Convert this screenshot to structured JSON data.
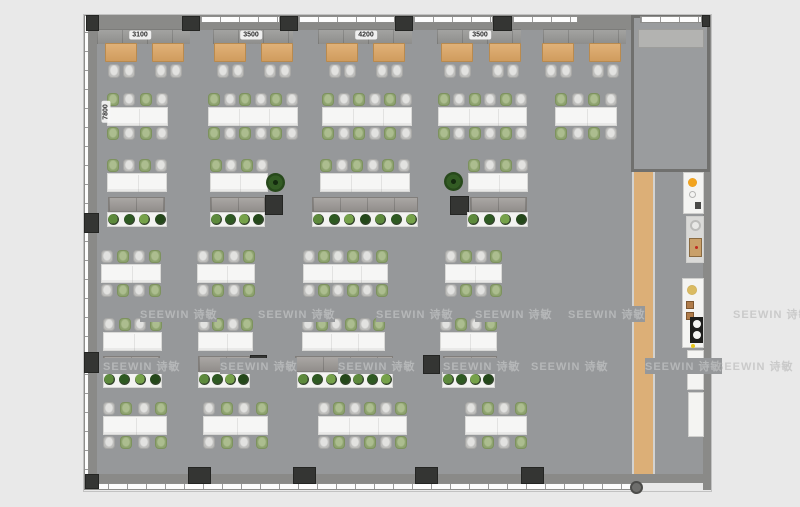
{
  "scene": {
    "width": 800,
    "height": 507,
    "background": "#e9e9e9",
    "floor_color": "#96989a",
    "accent_wood": "#dcaf77",
    "chair_green": "#8ea36f",
    "chair_gray": "#bebebc"
  },
  "dimension_labels": [
    {
      "text": "3100",
      "cx": 140,
      "cy": 35,
      "rot": 0
    },
    {
      "text": "3500",
      "cx": 251,
      "cy": 35,
      "rot": 0
    },
    {
      "text": "4200",
      "cx": 366,
      "cy": 35,
      "rot": 0
    },
    {
      "text": "3500",
      "cx": 480,
      "cy": 35,
      "rot": 0
    },
    {
      "text": "7800",
      "cx": 106,
      "cy": 112,
      "rot": -90
    }
  ],
  "watermark": {
    "text": "SEEWIN 诗敏",
    "instances": [
      {
        "x": 140,
        "y": 306,
        "v": "floor"
      },
      {
        "x": 258,
        "y": 306,
        "v": "floor"
      },
      {
        "x": 376,
        "y": 306,
        "v": "floor"
      },
      {
        "x": 475,
        "y": 306,
        "v": "floor"
      },
      {
        "x": 568,
        "y": 306,
        "v": "floor"
      },
      {
        "x": 733,
        "y": 306,
        "v": "margin"
      },
      {
        "x": 103,
        "y": 358,
        "v": "floor"
      },
      {
        "x": 220,
        "y": 358,
        "v": "floor"
      },
      {
        "x": 338,
        "y": 358,
        "v": "floor"
      },
      {
        "x": 443,
        "y": 358,
        "v": "floor"
      },
      {
        "x": 531,
        "y": 358,
        "v": "floor"
      },
      {
        "x": 645,
        "y": 358,
        "v": "floor"
      },
      {
        "x": 716,
        "y": 358,
        "v": "margin"
      }
    ]
  },
  "shell": {
    "floor": {
      "x": 89,
      "y": 16,
      "w": 614,
      "h": 458
    },
    "outline": {
      "x": 83,
      "y": 14,
      "w": 629,
      "h": 478
    },
    "top_band": {
      "x": 84,
      "y": 15,
      "w": 627,
      "h": 15
    },
    "bottom_band": {
      "x": 84,
      "y": 474,
      "w": 627,
      "h": 9
    },
    "left_band": {
      "x": 89,
      "y": 15,
      "w": 8,
      "h": 459
    },
    "right_band": {
      "x": 703,
      "y": 15,
      "w": 8,
      "h": 475
    },
    "windows_top": [
      {
        "x": 200,
        "y": 16,
        "w": 80,
        "h": 7
      },
      {
        "x": 298,
        "y": 16,
        "w": 97,
        "h": 7
      },
      {
        "x": 413,
        "y": 16,
        "w": 80,
        "h": 7
      },
      {
        "x": 512,
        "y": 16,
        "w": 66,
        "h": 7
      },
      {
        "x": 640,
        "y": 16,
        "w": 62,
        "h": 7
      }
    ],
    "window_bottom": {
      "x": 88,
      "y": 483,
      "w": 545,
      "h": 7
    },
    "window_left": {
      "x": 84,
      "y": 15,
      "w": 5,
      "h": 475
    },
    "wood_strip": {
      "x": 632,
      "y": 172,
      "w": 23,
      "h": 302
    },
    "room": {
      "x": 631,
      "y": 15,
      "w": 79,
      "h": 157,
      "strip": {
        "x": 638,
        "y": 29,
        "w": 66,
        "h": 19
      }
    },
    "round_column": {
      "x": 630,
      "y": 481,
      "d": 13
    }
  },
  "columns": [
    {
      "x": 86,
      "y": 15,
      "w": 13,
      "h": 16
    },
    {
      "x": 182,
      "y": 16,
      "w": 18,
      "h": 15
    },
    {
      "x": 280,
      "y": 16,
      "w": 18,
      "h": 15
    },
    {
      "x": 395,
      "y": 16,
      "w": 18,
      "h": 15
    },
    {
      "x": 493,
      "y": 16,
      "w": 19,
      "h": 15
    },
    {
      "x": 702,
      "y": 15,
      "w": 8,
      "h": 12
    },
    {
      "x": 84,
      "y": 213,
      "w": 15,
      "h": 20
    },
    {
      "x": 84,
      "y": 352,
      "w": 15,
      "h": 21
    },
    {
      "x": 265,
      "y": 195,
      "w": 18,
      "h": 20
    },
    {
      "x": 450,
      "y": 196,
      "w": 19,
      "h": 19
    },
    {
      "x": 250,
      "y": 355,
      "w": 17,
      "h": 19
    },
    {
      "x": 423,
      "y": 355,
      "w": 17,
      "h": 19
    },
    {
      "x": 85,
      "y": 474,
      "w": 14,
      "h": 15
    },
    {
      "x": 188,
      "y": 467,
      "w": 23,
      "h": 17
    },
    {
      "x": 293,
      "y": 467,
      "w": 23,
      "h": 17
    },
    {
      "x": 415,
      "y": 467,
      "w": 23,
      "h": 17
    },
    {
      "x": 521,
      "y": 467,
      "w": 23,
      "h": 17
    }
  ],
  "top_cabinets": [
    {
      "x": 97,
      "y": 29,
      "w": 93,
      "h": 15
    },
    {
      "x": 213,
      "y": 29,
      "w": 80,
      "h": 15
    },
    {
      "x": 318,
      "y": 29,
      "w": 94,
      "h": 15
    },
    {
      "x": 437,
      "y": 29,
      "w": 84,
      "h": 15
    },
    {
      "x": 543,
      "y": 29,
      "w": 83,
      "h": 15
    }
  ],
  "bench_tables": {
    "y": 43,
    "w": 32,
    "h": 19,
    "chair_y": 64,
    "xs": [
      105,
      152,
      214,
      261,
      326,
      373,
      441,
      489,
      542,
      589
    ]
  },
  "desk_clusters": [
    {
      "x": 107,
      "y": 107,
      "w": 61,
      "seats": 4,
      "sides": 2,
      "firstGreen": true
    },
    {
      "x": 208,
      "y": 107,
      "w": 90,
      "seats": 6,
      "sides": 2,
      "firstGreen": true
    },
    {
      "x": 322,
      "y": 107,
      "w": 90,
      "seats": 6,
      "sides": 2,
      "firstGreen": true
    },
    {
      "x": 438,
      "y": 107,
      "w": 89,
      "seats": 6,
      "sides": 2,
      "firstGreen": true
    },
    {
      "x": 555,
      "y": 107,
      "w": 62,
      "seats": 4,
      "sides": 2,
      "firstGreen": true
    },
    {
      "x": 107,
      "y": 173,
      "w": 60,
      "seats": 4,
      "sides": 1,
      "firstGreen": true
    },
    {
      "x": 210,
      "y": 173,
      "w": 58,
      "seats": 4,
      "sides": 1,
      "firstGreen": true
    },
    {
      "x": 320,
      "y": 173,
      "w": 90,
      "seats": 6,
      "sides": 1,
      "firstGreen": true
    },
    {
      "x": 468,
      "y": 173,
      "w": 60,
      "seats": 4,
      "sides": 1,
      "firstGreen": true
    },
    {
      "x": 101,
      "y": 264,
      "w": 60,
      "seats": 4,
      "sides": 2,
      "firstGreen": false
    },
    {
      "x": 197,
      "y": 264,
      "w": 58,
      "seats": 4,
      "sides": 2,
      "firstGreen": false
    },
    {
      "x": 303,
      "y": 264,
      "w": 85,
      "seats": 6,
      "sides": 2,
      "firstGreen": false
    },
    {
      "x": 445,
      "y": 264,
      "w": 57,
      "seats": 4,
      "sides": 2,
      "firstGreen": false
    },
    {
      "x": 103,
      "y": 332,
      "w": 59,
      "seats": 4,
      "sides": 1,
      "firstGreen": false
    },
    {
      "x": 198,
      "y": 332,
      "w": 55,
      "seats": 4,
      "sides": 1,
      "firstGreen": false
    },
    {
      "x": 302,
      "y": 332,
      "w": 83,
      "seats": 6,
      "sides": 1,
      "firstGreen": false
    },
    {
      "x": 440,
      "y": 332,
      "w": 57,
      "seats": 4,
      "sides": 1,
      "firstGreen": false
    },
    {
      "x": 103,
      "y": 416,
      "w": 64,
      "seats": 4,
      "sides": 2,
      "firstGreen": false
    },
    {
      "x": 203,
      "y": 416,
      "w": 65,
      "seats": 4,
      "sides": 2,
      "firstGreen": false
    },
    {
      "x": 318,
      "y": 416,
      "w": 89,
      "seats": 6,
      "sides": 2,
      "firstGreen": false
    },
    {
      "x": 465,
      "y": 416,
      "w": 62,
      "seats": 4,
      "sides": 2,
      "firstGreen": false
    }
  ],
  "cabinets": [
    {
      "x": 108,
      "y": 197,
      "w": 57,
      "h": 15
    },
    {
      "x": 210,
      "y": 197,
      "w": 55,
      "h": 15
    },
    {
      "x": 312,
      "y": 197,
      "w": 106,
      "h": 15
    },
    {
      "x": 470,
      "y": 197,
      "w": 57,
      "h": 15
    },
    {
      "x": 103,
      "y": 356,
      "w": 57,
      "h": 16
    },
    {
      "x": 198,
      "y": 356,
      "w": 52,
      "h": 16
    },
    {
      "x": 295,
      "y": 356,
      "w": 98,
      "h": 16
    },
    {
      "x": 443,
      "y": 356,
      "w": 54,
      "h": 16
    }
  ],
  "planters": [
    {
      "x": 107,
      "y": 212,
      "w": 60,
      "h": 15,
      "n": 4
    },
    {
      "x": 210,
      "y": 212,
      "w": 55,
      "h": 15,
      "n": 4
    },
    {
      "x": 312,
      "y": 212,
      "w": 106,
      "h": 15,
      "n": 7
    },
    {
      "x": 467,
      "y": 212,
      "w": 61,
      "h": 15,
      "n": 4
    },
    {
      "x": 103,
      "y": 372,
      "w": 59,
      "h": 16,
      "n": 4
    },
    {
      "x": 198,
      "y": 372,
      "w": 52,
      "h": 16,
      "n": 4
    },
    {
      "x": 297,
      "y": 372,
      "w": 96,
      "h": 16,
      "n": 7
    },
    {
      "x": 442,
      "y": 372,
      "w": 53,
      "h": 16,
      "n": 4
    }
  ],
  "plant_colors": [
    "#5d8a3c",
    "#2e5a22",
    "#76a24a",
    "#24481a"
  ],
  "trees": [
    {
      "x": 266,
      "y": 173,
      "s": 19
    },
    {
      "x": 444,
      "y": 172,
      "s": 19
    }
  ],
  "fixtures": [
    {
      "x": 683,
      "y": 172,
      "w": 21,
      "h": 42,
      "kind": "service"
    },
    {
      "x": 686,
      "y": 216,
      "w": 18,
      "h": 47,
      "kind": "coffee"
    },
    {
      "x": 682,
      "y": 278,
      "w": 22,
      "h": 70,
      "kind": "sink"
    },
    {
      "x": 687,
      "y": 350,
      "w": 17,
      "h": 40,
      "kind": "counter"
    },
    {
      "x": 688,
      "y": 392,
      "w": 16,
      "h": 45,
      "kind": "counter"
    }
  ]
}
